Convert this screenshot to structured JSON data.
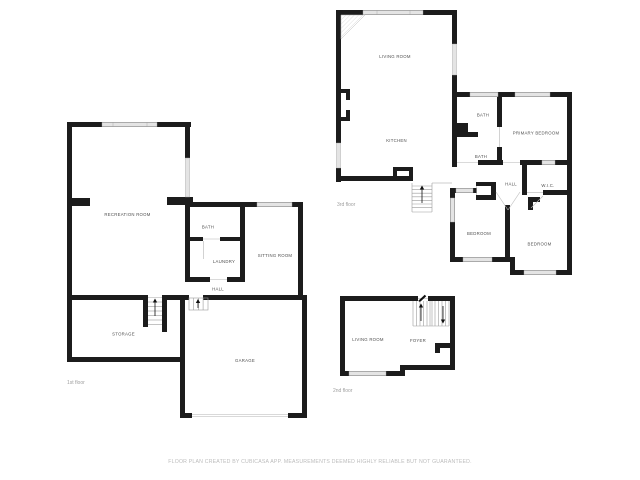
{
  "page": {
    "background": "#ffffff"
  },
  "palette": {
    "wall": "#1c1c1c",
    "window_fill": "#e4e4e4",
    "window_edge": "#a6a6a6",
    "room_label": "#4f4f4f",
    "floor_label": "#9e9e9e",
    "detail_line": "#9b9b9b",
    "footer_text": "#bcbcbc"
  },
  "floors": [
    {
      "name": "first-floor",
      "label": "1st floor",
      "rooms": [
        {
          "label": "RECREATION ROOM"
        },
        {
          "label": "BATH"
        },
        {
          "label": "LAUNDRY"
        },
        {
          "label": "SITTING ROOM"
        },
        {
          "label": "HALL"
        },
        {
          "label": "STORAGE"
        },
        {
          "label": "GARAGE"
        }
      ]
    },
    {
      "name": "third-floor",
      "label": "3rd floor",
      "rooms": [
        {
          "label": "LIVING ROOM"
        },
        {
          "label": "KITCHEN"
        },
        {
          "label": "BATH"
        },
        {
          "label": "PRIMARY BEDROOM"
        },
        {
          "label": "BATH"
        },
        {
          "label": "HALL"
        },
        {
          "label": "W.I.C."
        },
        {
          "label": "BEDROOM"
        },
        {
          "label": "BEDROOM"
        }
      ]
    },
    {
      "name": "second-floor",
      "label": "2nd floor",
      "rooms": [
        {
          "label": "LIVING ROOM"
        },
        {
          "label": "FOYER"
        }
      ]
    }
  ],
  "footer": {
    "disclaimer": "FLOOR PLAN CREATED BY CUBICASA APP. MEASUREMENTS DEEMED HIGHLY RELIABLE BUT NOT GUARANTEED."
  }
}
